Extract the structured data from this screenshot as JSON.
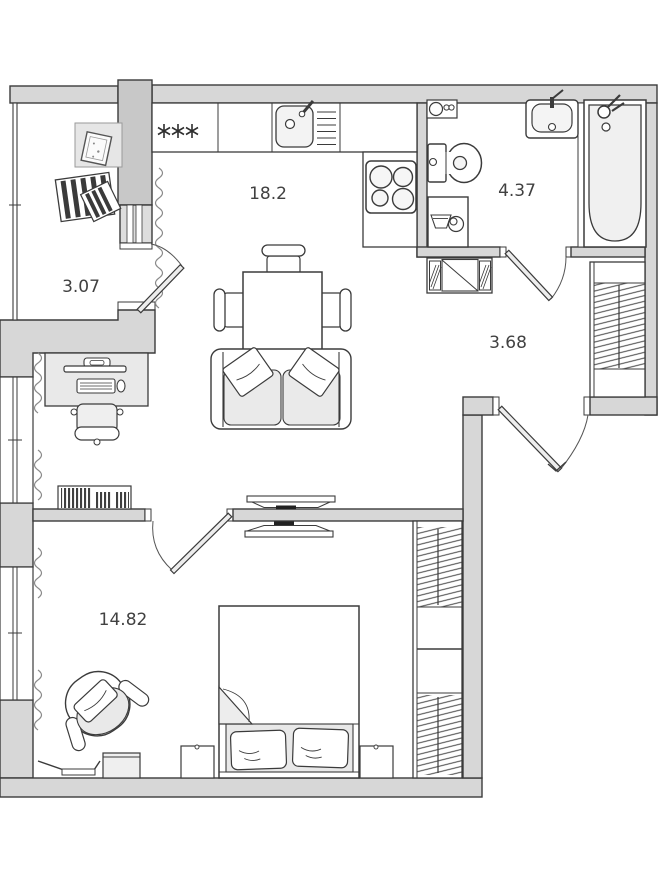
{
  "palette": {
    "wall_fill": "#d7d7d7",
    "column_fill": "#c8c8c8",
    "line_color": "#3b3b3b",
    "soft_fill": "#e9e9e9",
    "text_color": "#414141",
    "background": "#ffffff"
  },
  "rooms": [
    {
      "name": "kitchen-living-room",
      "area": "18.2"
    },
    {
      "name": "loggia",
      "area": "3.07"
    },
    {
      "name": "bathroom",
      "area": "4.37"
    },
    {
      "name": "hallway",
      "area": "3.68"
    },
    {
      "name": "bedroom",
      "area": "14.82"
    }
  ],
  "symbols": {
    "stove_marks": "***"
  }
}
